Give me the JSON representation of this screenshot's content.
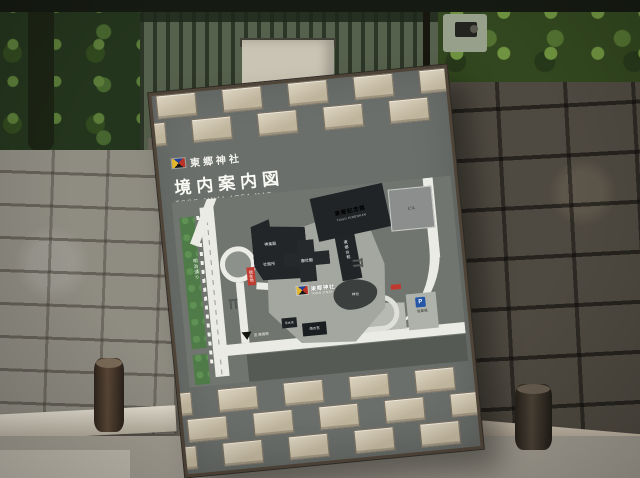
{
  "sign": {
    "shrine_name": "東郷神社",
    "map_title": "境内案内図",
    "map_title_en": "TOGO JINJA AREA MAP",
    "side_caption": "東郷神社境内案内図"
  },
  "map": {
    "you_are_here": "現在地",
    "streets": {
      "left_avenue": "明治通り",
      "bottom_street": "竹下通り",
      "right_street": "原宿通り",
      "station_direction": "至 原宿駅"
    },
    "places": {
      "main_shrine_ja": "東郷神社",
      "main_shrine_en": "TOGO JINJA",
      "memorial_ja": "東郷記念館",
      "memorial_en": "TOGO KINENKAN",
      "main_hall": "御社殿",
      "kagura_hall": "神楽殿",
      "shrine_office": "社務所",
      "togo_hall": "東郷会館",
      "uminomiya": "海の宮",
      "temizuya": "手水舎",
      "pond": "神池",
      "office_building": "ビル"
    },
    "parking": {
      "p": "P",
      "label": "駐車場"
    }
  },
  "colors": {
    "you_are_here_red": "#c13b30",
    "parking_blue": "#2456a8",
    "avenue_green": "#4e7b47",
    "panel_gray": "#6b6f6b",
    "tile_beige": "#cfc5ae"
  }
}
